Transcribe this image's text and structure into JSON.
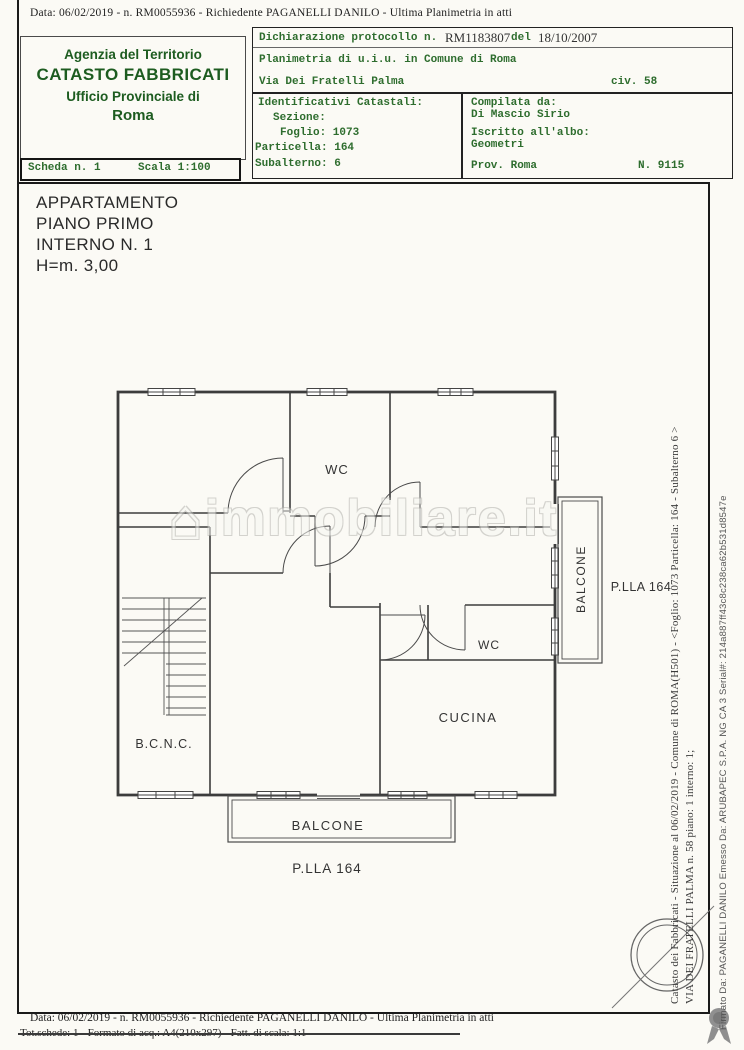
{
  "header": {
    "top_line": "Data: 06/02/2019 -  n. RM0055936 - Richiedente PAGANELLI DANILO - Ultima Planimetria in atti"
  },
  "agency": {
    "line1": "Agenzia del Territorio",
    "line2": "CATASTO FABBRICATI",
    "line3": "Ufficio Provinciale di",
    "line4": "Roma"
  },
  "scheda": {
    "scheda": "Scheda n. 1",
    "scala": "Scala 1:100"
  },
  "decl": {
    "protocol_label": "Dichiarazione protocollo n.",
    "protocol_value": "RM1183807",
    "del_label": "del",
    "protocol_date": "18/10/2007",
    "line2": "Planimetria di u.i.u. in Comune di Roma",
    "street": "Via Dei Fratelli Palma",
    "civ": "civ. 58",
    "identificativi_title": "Identificativi Catastali:",
    "sezione": "Sezione:",
    "foglio": "Foglio: 1073",
    "particella": "Particella: 164",
    "subalterno": "Subalterno: 6",
    "compilata_label": "Compilata da:",
    "compilata_name": "Di Mascio Sirio",
    "iscritto_label": "Iscritto all'albo:",
    "iscritto_value": "Geometri",
    "prov": "Prov. Roma",
    "albo_n": "N. 9115"
  },
  "apartment": {
    "line1": "APPARTAMENTO",
    "line2": "PIANO PRIMO",
    "line3": "INTERNO N. 1",
    "line4": "H=m. 3,00"
  },
  "plan_labels": {
    "wc_top": "WC",
    "wc_mid": "WC",
    "cucina": "CUCINA",
    "bcnc": "B.C.N.C.",
    "balcone_bottom": "BALCONE",
    "balcone_right": "BALCONE",
    "plla_bottom": "P.LLA 164",
    "plla_right": "P.LLA 164"
  },
  "watermark": {
    "house": "⌂",
    "text": "immobiliare.it"
  },
  "side_text": {
    "inner_line1": "Catasto dei Fabbricati - Situazione al 06/02/2019 - Comune di ROMA(H501) - <Foglio: 1073 Particella: 164 - Subalterno 6 >",
    "inner_line2": "VIA DEI FRATELLI PALMA n. 58 piano: 1 interno: 1;",
    "outer_line": "Firmato Da: PAGANELLI DANILO Emesso Da: ARUBAPEC S.P.A. NG CA 3 Serial#: 214a887ff43c8c238ca62b531d8547e"
  },
  "footer": {
    "line1": "Data: 06/02/2019 -  n. RM0055936 - Richiedente PAGANELLI DANILO - Ultima Planimetria in atti",
    "line2": "Tot.schede:  1 - Formato di acq.:  A4(210x297) - Fatt. di scala: 1:1"
  },
  "colors": {
    "green_header": "#1d5c20",
    "green_text": "#2e6d2e",
    "ink": "#2a2a2a",
    "wall": "#3c3c3c",
    "paper": "#fbfaf5"
  }
}
